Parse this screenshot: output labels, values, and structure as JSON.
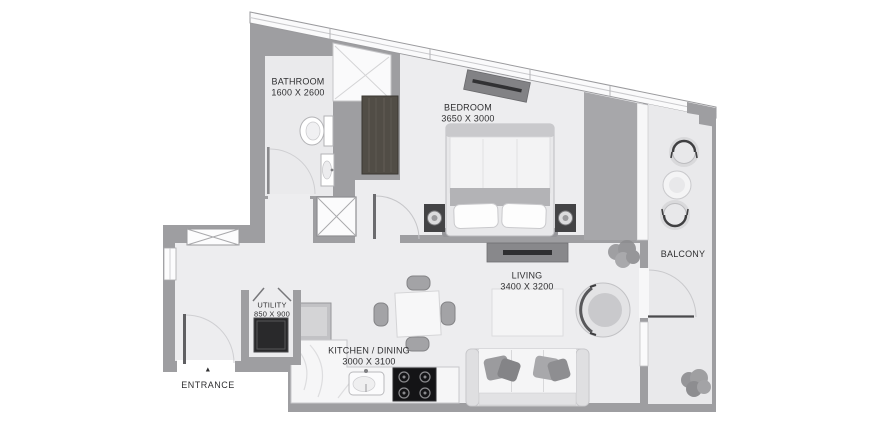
{
  "rooms": {
    "bathroom": {
      "name": "BATHROOM",
      "dims": "1600 X 2600"
    },
    "bedroom": {
      "name": "BEDROOM",
      "dims": "3650 X 3000"
    },
    "living": {
      "name": "LIVING",
      "dims": "3400 X 3200"
    },
    "kitchen": {
      "name": "KITCHEN / DINING",
      "dims": "3000 X 3100"
    },
    "utility": {
      "name": "UTILITY",
      "dims": "850 X 900"
    },
    "balcony": {
      "name": "BALCONY"
    },
    "entrance": {
      "name": "ENTRANCE",
      "arrow_glyph": "▲"
    }
  },
  "colors": {
    "wall": "#9e9ea1",
    "wall_dark_block": "#a7a7aa",
    "floor": "#ededef",
    "floor_bathroom": "#eaeaec",
    "floor_balcony": "#e9e9eb",
    "window_white": "#fafafb",
    "text": "#2f2f31",
    "appliance_dark": "#29292b",
    "stove_black": "#141416",
    "wardrobe_wood": "#514d46"
  },
  "furniture": [
    "bed",
    "pillows",
    "nightstand-left",
    "nightstand-right",
    "wardrobe",
    "bedroom-tv-console",
    "toilet",
    "bathroom-sink",
    "shower",
    "lift-shaft",
    "wall-vent-panel",
    "washing-machine",
    "fridge",
    "kitchen-counter",
    "kitchen-sink",
    "stove",
    "dining-table",
    "dining-chairs",
    "sofa",
    "sofa-pillows",
    "rug",
    "armchair",
    "living-tv-console",
    "plant-living",
    "plant-balcony",
    "balcony-chairs",
    "balcony-table",
    "entrance-door",
    "bathroom-door",
    "bedroom-door",
    "balcony-door",
    "utility-door"
  ]
}
